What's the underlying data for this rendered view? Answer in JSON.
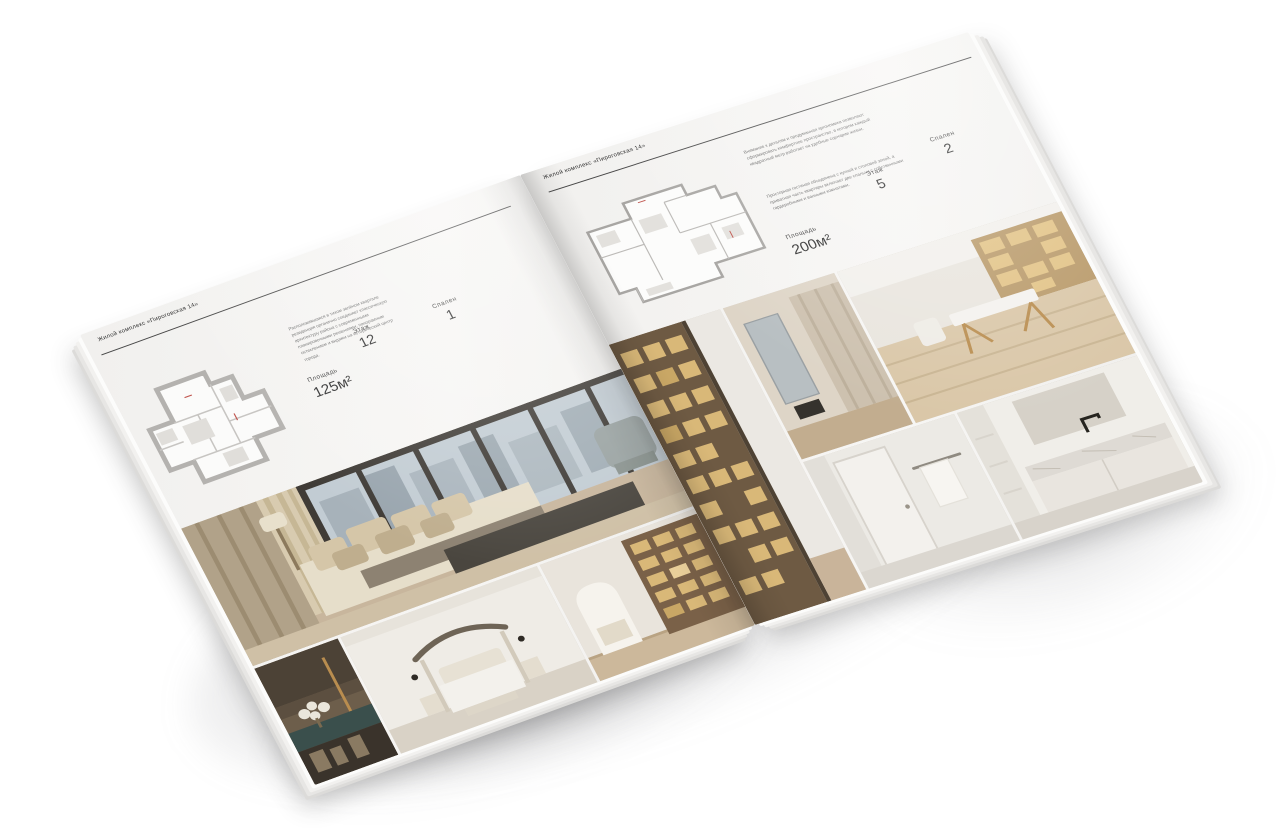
{
  "background_color": "#ffffff",
  "left": {
    "header": "Жилой комплекс «Пироговская 14»",
    "description": "Расположившаяся в тихом зелёном квартале резиденция органично соединяет классическую архитектуру района с современными планировочными решениями, панорамным остеклением и видами на исторический центр города.",
    "stats": {
      "area_label": "Площадь",
      "area_value": "125м²",
      "floor_label": "Этаж",
      "floor_value": "12",
      "bedrooms_label": "Спален",
      "bedrooms_value": "1"
    }
  },
  "right": {
    "header": "Жилой комплекс «Пироговская 14»",
    "description_1": "Внимание к деталям и продуманная эргономика позволяют сформировать комфортное пространство, в котором каждый квадратный метр работает на удобные сценарии жизни.",
    "description_2": "Просторная гостиная объединена с кухней и столовой зоной, а приватная часть квартиры включает две спальни с собственными гардеробными и ванными комнатами.",
    "stats": {
      "area_label": "Площадь",
      "area_value": "200м²",
      "floor_label": "Этаж",
      "floor_value": "5",
      "bedrooms_label": "Спален",
      "bedrooms_value": "2"
    }
  },
  "palette": {
    "paper": "#f5f4f2",
    "ink": "#2f2f2f",
    "rule": "#474747",
    "plan_wall": "#b4b2af",
    "photo_warm_beige": "#c8b69d",
    "photo_wood": "#7a6148",
    "photo_shelf_glow": "#d9b878",
    "photo_dark_chaise": "#4a463f",
    "photo_teal_console": "#3a4f4c",
    "photo_sky": "#c2ccd3",
    "photo_marble": "#dedad4",
    "gold_accent": "#b98d4f"
  }
}
